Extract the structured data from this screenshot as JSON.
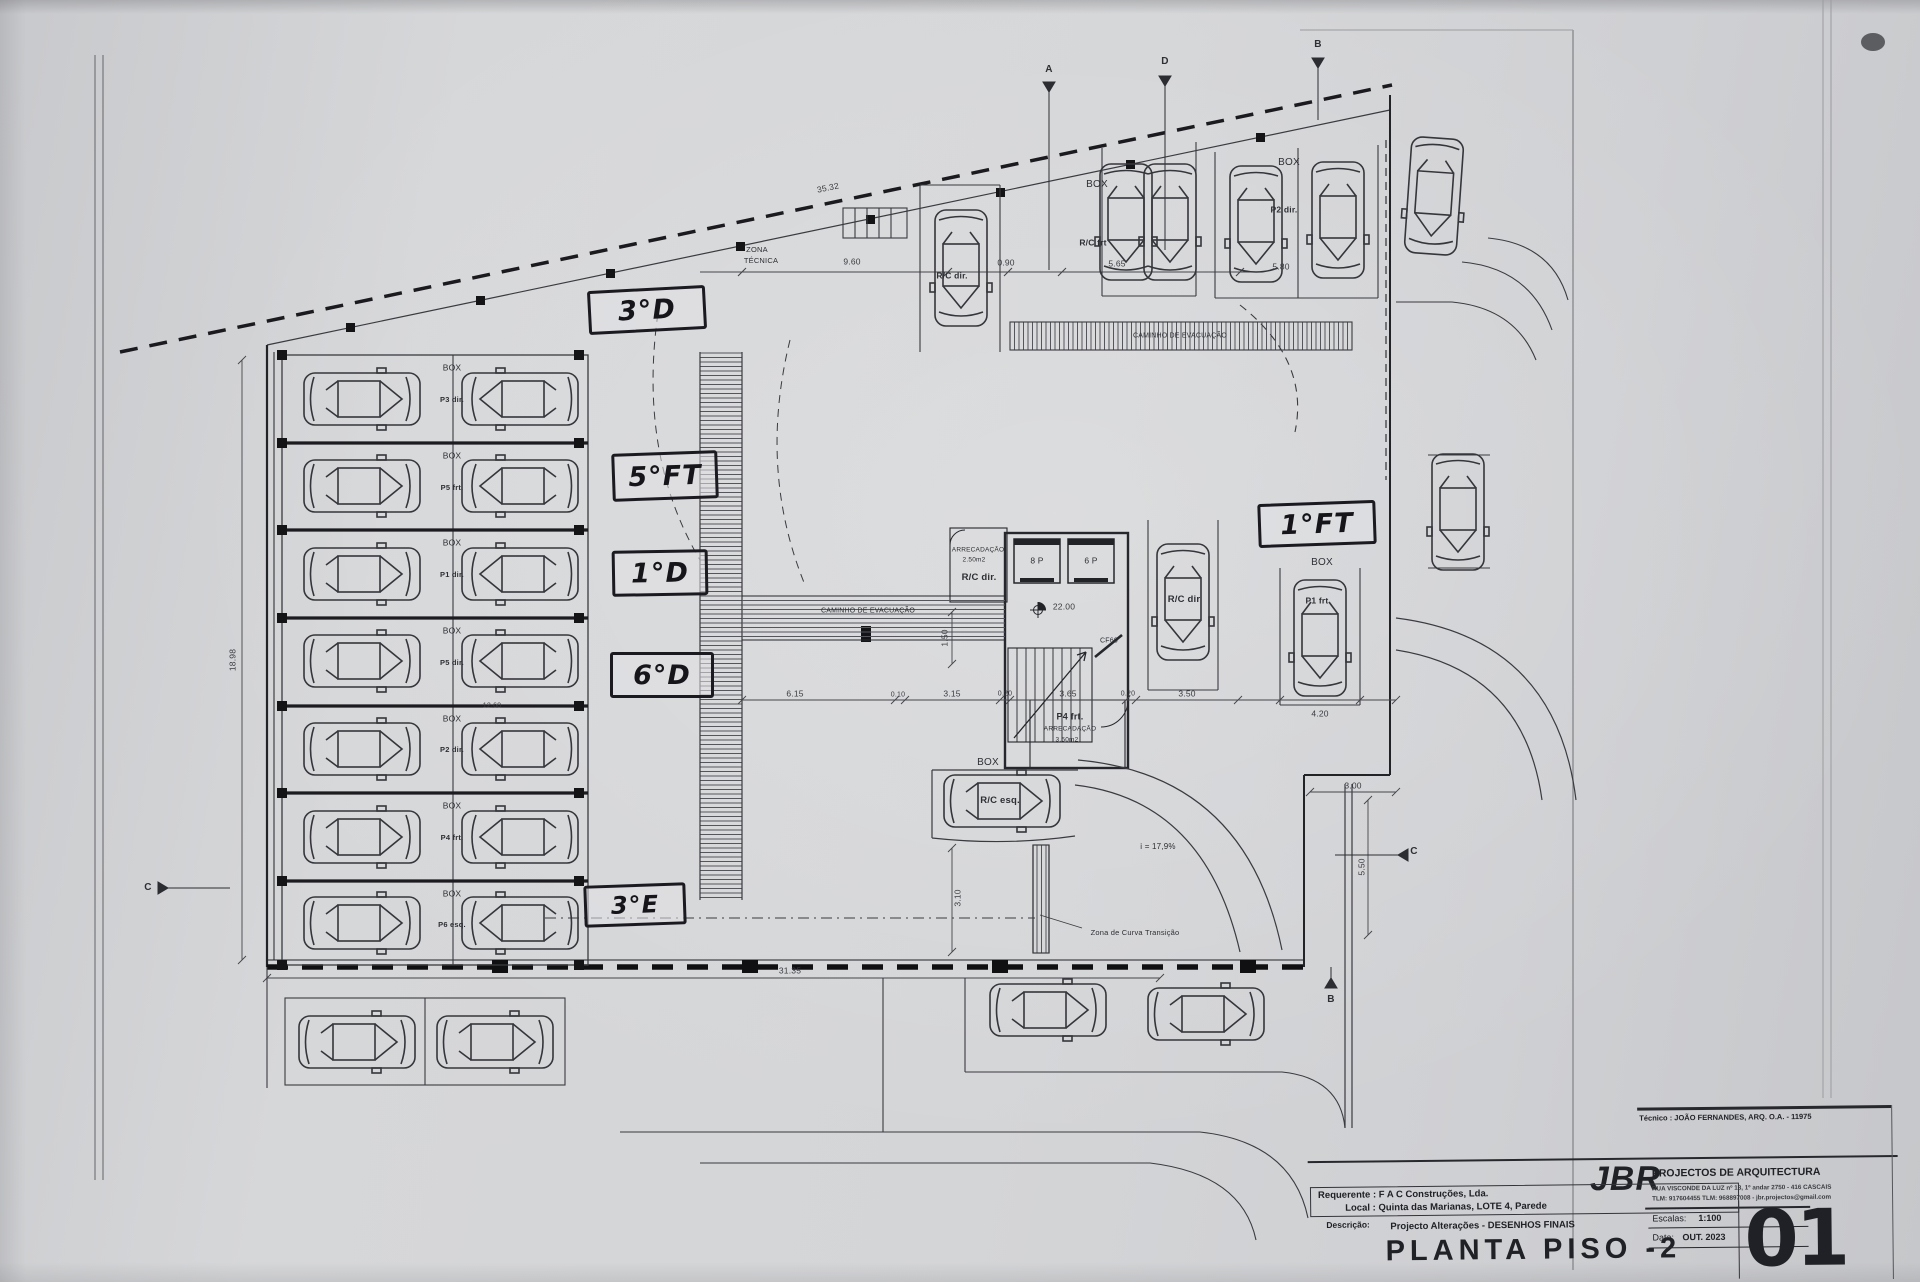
{
  "annotations": {
    "a1": "3°D",
    "a2": "5°FT",
    "a3": "1°D",
    "a4": "6°D",
    "a5": "3°E",
    "a6": "1°FT"
  },
  "t": {
    "box": "BOX",
    "zona1": "ZONA",
    "zona2": "TÉCNICA",
    "caminho": "CAMINHO DE EVACUAÇÃO",
    "rc_frt": "R/C frt",
    "rc_dir": "R/C dir.",
    "rc_dir2": "R/C dir",
    "rc_esq": "R/C esq.",
    "p2_dir": "P2 dir.",
    "p1_frt": "P1 frt",
    "p4_frt": "P4 frt.",
    "arrecadacao": "ARRECADAÇÃO",
    "area_250": "2.50m2",
    "area_350": "3.50m2",
    "cf60": "CF60",
    "level": "22.00",
    "elev_left": "8 P",
    "elev_right": "6 P",
    "slope": "i = 17,9%",
    "curva": "Zona de Curva Transição"
  },
  "rows": [
    {
      "label": "P3 dir."
    },
    {
      "label": "P5 frt."
    },
    {
      "label": "P1 dir."
    },
    {
      "label": "P5 dir."
    },
    {
      "label": "P2 dir."
    },
    {
      "label": "P4 frt."
    },
    {
      "label": "P6 esq."
    }
  ],
  "dims": {
    "d1": "35.32",
    "d2": "9.60",
    "d3": "0.90",
    "d4": "5.65",
    "d5": "5.80",
    "d6": "6.15",
    "d7": "0.10",
    "d8": "3.15",
    "d9": "0.20",
    "d10": "3.65",
    "d11": "0.20",
    "d12": "3.50",
    "d13": "4.20",
    "d14": "3.00",
    "d15": "5.50",
    "d16": "3.10",
    "d17": "1.50",
    "d18": "31.35",
    "d19": "18.98",
    "d20": "12.60"
  },
  "markers": {
    "a": "A",
    "b": "B",
    "c": "C",
    "d": "D"
  },
  "title": {
    "tecnico": "Técnico : JOÃO FERNANDES, ARQ.   O.A. - 11975",
    "requerente": "Requerente : F A C  Construções, Lda.",
    "local": "Local : Quinta das Marianas, LOTE 4, Parede",
    "descricao_label": "Descrição:",
    "descricao": "Projecto Alterações - DESENHOS FINAIS",
    "plan_title": "PLANTA PISO -2",
    "firm": "JBR",
    "firm_sub": "PROJECTOS DE ARQUITECTURA",
    "addr1": "RUA VISCONDE DA LUZ nº 18, 1º andar  2750 - 416  CASCAIS",
    "addr2": "TLM: 917604455  TLM: 968897008 - jbr.projectos@gmail.com",
    "escala_label": "Escalas:",
    "escala": "1:100",
    "data_label": "Data:",
    "data": "OUT.  2023",
    "sheet": "01"
  }
}
